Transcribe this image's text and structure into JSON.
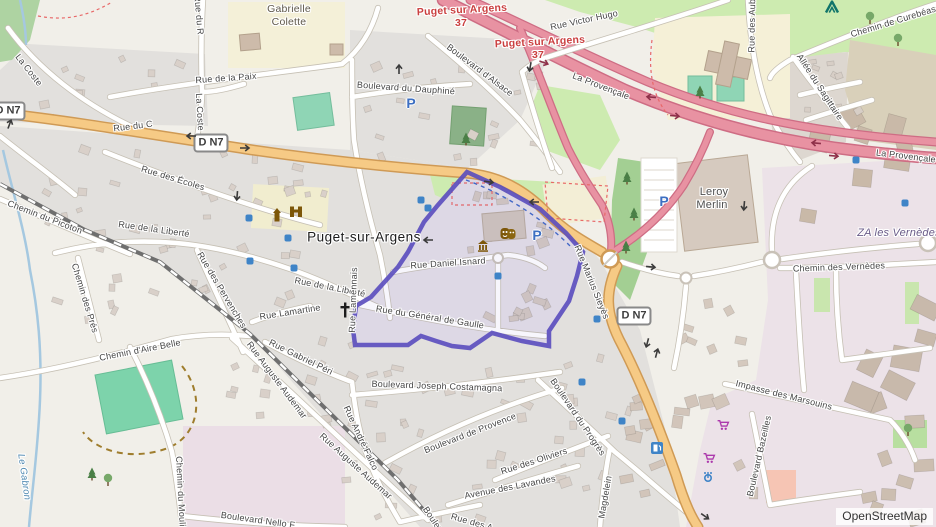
{
  "map": {
    "place": "Puget-sur-Argens",
    "attribution": "OpenStreetMap",
    "colors": {
      "motorway": "#e892a2",
      "primary": "#f6ca85",
      "highlight_boundary": "#5a4cbe",
      "water": "#a5c8e0",
      "grass": "#cdebb0",
      "pitch": "#8fd5b5",
      "residential": "#e2e0dd",
      "industrial": "#ece2e8",
      "school": "#f4efd6",
      "building": "#d9d0c9",
      "parking_blue": "#3d6fc2",
      "shop_purple": "#ac39ac",
      "historic_brown": "#7d5709",
      "junction_red": "#ca3f3f"
    },
    "badges": [
      {
        "t": "D N7",
        "x": 8,
        "y": 111
      },
      {
        "t": "D N7",
        "x": 211,
        "y": 143
      },
      {
        "t": "D N7",
        "x": 634,
        "y": 316
      }
    ],
    "labels": [
      {
        "t": "Gabrielle",
        "x": 289,
        "y": 9,
        "r": 0,
        "c": "area"
      },
      {
        "t": "Colette",
        "x": 289,
        "y": 22,
        "r": 0,
        "c": "area"
      },
      {
        "t": "La Coste",
        "x": 29,
        "y": 70,
        "r": 52
      },
      {
        "t": "Rue du R",
        "x": 199,
        "y": 15,
        "r": 85
      },
      {
        "t": "La Coste",
        "x": 200,
        "y": 112,
        "r": 87
      },
      {
        "t": "Rue de la Paix",
        "x": 226,
        "y": 78,
        "r": -4
      },
      {
        "t": "Rue du C",
        "x": 133,
        "y": 126,
        "r": -7
      },
      {
        "t": "Rue des Écoles",
        "x": 173,
        "y": 178,
        "r": 17
      },
      {
        "t": "Chemin du Picoton",
        "x": 45,
        "y": 217,
        "r": 21
      },
      {
        "t": "Rue de la Liberté",
        "x": 154,
        "y": 229,
        "r": 8
      },
      {
        "t": "Rue de la Liberté",
        "x": 330,
        "y": 287,
        "r": 11
      },
      {
        "t": "Chemin des Prés",
        "x": 85,
        "y": 298,
        "r": 73
      },
      {
        "t": "Rue des Pervenches",
        "x": 222,
        "y": 290,
        "r": 59
      },
      {
        "t": "Rue Lamartine",
        "x": 290,
        "y": 312,
        "r": -9
      },
      {
        "t": "Rue Lamennais",
        "x": 353,
        "y": 300,
        "r": -88
      },
      {
        "t": "Puget-sur-Argens",
        "x": 364,
        "y": 237,
        "r": 0,
        "c": "town"
      },
      {
        "t": "Rue Daniel Isnard",
        "x": 448,
        "y": 263,
        "r": -4
      },
      {
        "t": "Rue du Général de Gaulle",
        "x": 430,
        "y": 317,
        "r": 9
      },
      {
        "t": "Rue Marius Sieyès",
        "x": 592,
        "y": 282,
        "r": 68
      },
      {
        "t": "Boulevard du Dauphiné",
        "x": 406,
        "y": 88,
        "r": 4
      },
      {
        "t": "Boulevard d'Alsace",
        "x": 480,
        "y": 70,
        "r": 37
      },
      {
        "t": "Rue Victor Hugo",
        "x": 584,
        "y": 20,
        "r": -12
      },
      {
        "t": "La Provençale",
        "x": 601,
        "y": 86,
        "r": 21
      },
      {
        "t": "La Provençale",
        "x": 906,
        "y": 156,
        "r": 7
      },
      {
        "t": "Chemin de Curebéasse",
        "x": 898,
        "y": 20,
        "r": -17
      },
      {
        "t": "Rue des Aubrèdes",
        "x": 752,
        "y": 14,
        "r": -89
      },
      {
        "t": "Allée du Sagittaire",
        "x": 820,
        "y": 87,
        "r": 57
      },
      {
        "t": "Leroy",
        "x": 714,
        "y": 192,
        "r": 0,
        "c": "poiname"
      },
      {
        "t": "Merlin",
        "x": 712,
        "y": 205,
        "r": 0,
        "c": "poiname"
      },
      {
        "t": "ZA les Vernèdes",
        "x": 899,
        "y": 233,
        "r": 0,
        "c": "landuse"
      },
      {
        "t": "Chemin des Vernèdes",
        "x": 839,
        "y": 267,
        "r": -2
      },
      {
        "t": "Puget sur Argens",
        "x": 462,
        "y": 10,
        "r": -3,
        "c": "junction"
      },
      {
        "t": "37",
        "x": 461,
        "y": 23,
        "r": 0,
        "c": "junction"
      },
      {
        "t": "Puget sur Argens",
        "x": 540,
        "y": 42,
        "r": -3,
        "c": "junction"
      },
      {
        "t": "37",
        "x": 538,
        "y": 55,
        "r": 0,
        "c": "junction"
      },
      {
        "t": "Chemin d'Aire Belle",
        "x": 140,
        "y": 350,
        "r": -11
      },
      {
        "t": "Le Gabron",
        "x": 24,
        "y": 477,
        "r": 82,
        "c": "water"
      },
      {
        "t": "Rue Gabriel Péri",
        "x": 301,
        "y": 357,
        "r": 26
      },
      {
        "t": "Rue Auguste Audemar",
        "x": 277,
        "y": 380,
        "r": 53
      },
      {
        "t": "Rue Auguste Audemar",
        "x": 356,
        "y": 466,
        "r": 42
      },
      {
        "t": "Chemin du Moulin",
        "x": 181,
        "y": 494,
        "r": 87
      },
      {
        "t": "Boulevard Nello F",
        "x": 258,
        "y": 520,
        "r": 8
      },
      {
        "t": "Rue André Falco",
        "x": 361,
        "y": 438,
        "r": 65
      },
      {
        "t": "Boulevard Joseph Costamagna",
        "x": 437,
        "y": 386,
        "r": 2
      },
      {
        "t": "Boulevard de Provence",
        "x": 470,
        "y": 433,
        "r": -21
      },
      {
        "t": "Rue des Oliviers",
        "x": 534,
        "y": 461,
        "r": -18
      },
      {
        "t": "Avenue des Lavandes",
        "x": 510,
        "y": 487,
        "r": -11
      },
      {
        "t": "Boulevard du Progrès",
        "x": 578,
        "y": 417,
        "r": 56
      },
      {
        "t": "Magdelein",
        "x": 605,
        "y": 497,
        "r": -80
      },
      {
        "t": "Impasse des Marsouins",
        "x": 784,
        "y": 395,
        "r": 14
      },
      {
        "t": "Boulevard Bazeilles",
        "x": 759,
        "y": 456,
        "r": -77
      },
      {
        "t": "Rue des A",
        "x": 472,
        "y": 522,
        "r": 16
      },
      {
        "t": "Boulevard",
        "x": 437,
        "y": 525,
        "r": 56
      }
    ],
    "icons": [
      {
        "k": "parking",
        "x": 411,
        "y": 103
      },
      {
        "k": "parking",
        "x": 537,
        "y": 235
      },
      {
        "k": "parking",
        "x": 664,
        "y": 201
      },
      {
        "k": "poi-dot",
        "x": 249,
        "y": 218
      },
      {
        "k": "poi-dot",
        "x": 288,
        "y": 238
      },
      {
        "k": "poi-dot",
        "x": 250,
        "y": 261
      },
      {
        "k": "poi-dot",
        "x": 294,
        "y": 268
      },
      {
        "k": "poi-dot",
        "x": 421,
        "y": 200
      },
      {
        "k": "poi-dot",
        "x": 428,
        "y": 208
      },
      {
        "k": "poi-dot",
        "x": 498,
        "y": 276
      },
      {
        "k": "poi-dot",
        "x": 597,
        "y": 319
      },
      {
        "k": "poi-dot",
        "x": 582,
        "y": 382
      },
      {
        "k": "poi-dot",
        "x": 622,
        "y": 421
      },
      {
        "k": "poi-dot",
        "x": 856,
        "y": 160
      },
      {
        "k": "poi-dot",
        "x": 905,
        "y": 203
      },
      {
        "k": "supermarket-cart",
        "x": 723,
        "y": 425
      },
      {
        "k": "supermarket-cart",
        "x": 709,
        "y": 458
      },
      {
        "k": "fountain",
        "x": 708,
        "y": 476
      },
      {
        "k": "fuel",
        "x": 657,
        "y": 448
      },
      {
        "k": "campsite-tent",
        "x": 832,
        "y": 7
      },
      {
        "k": "historic-tower",
        "x": 277,
        "y": 215
      },
      {
        "k": "city-gate",
        "x": 296,
        "y": 211
      },
      {
        "k": "theatre-masks",
        "x": 508,
        "y": 234
      },
      {
        "k": "monument",
        "x": 483,
        "y": 246
      },
      {
        "k": "church-cross",
        "x": 345,
        "y": 310
      },
      {
        "k": "tree-conifer",
        "x": 466,
        "y": 139
      },
      {
        "k": "tree-conifer",
        "x": 627,
        "y": 178
      },
      {
        "k": "tree-conifer",
        "x": 634,
        "y": 214
      },
      {
        "k": "tree-conifer",
        "x": 626,
        "y": 247
      },
      {
        "k": "tree-conifer",
        "x": 700,
        "y": 92
      },
      {
        "k": "tree-conifer",
        "x": 92,
        "y": 474
      },
      {
        "k": "tree-round",
        "x": 870,
        "y": 18
      },
      {
        "k": "tree-round",
        "x": 898,
        "y": 40
      },
      {
        "k": "tree-round",
        "x": 108,
        "y": 480
      },
      {
        "k": "tree-round",
        "x": 908,
        "y": 430
      },
      {
        "k": "oneway-arrow",
        "x": 10,
        "y": 123,
        "r": -70
      },
      {
        "k": "oneway-arrow",
        "x": 190,
        "y": 136,
        "r": 180
      },
      {
        "k": "oneway-arrow",
        "x": 246,
        "y": 148,
        "r": 0
      },
      {
        "k": "oneway-arrow",
        "x": 399,
        "y": 68,
        "r": -90
      },
      {
        "k": "oneway-arrow",
        "x": 530,
        "y": 68,
        "r": 100
      },
      {
        "k": "oneway-arrow",
        "x": 237,
        "y": 197,
        "r": 95
      },
      {
        "k": "oneway-arrow",
        "x": 490,
        "y": 182,
        "r": 8
      },
      {
        "k": "oneway-arrow",
        "x": 427,
        "y": 240,
        "r": 180
      },
      {
        "k": "oneway-arrow",
        "x": 533,
        "y": 202,
        "r": 180
      },
      {
        "k": "oneway-arrow",
        "x": 744,
        "y": 207,
        "r": 95
      },
      {
        "k": "oneway-arrow",
        "x": 652,
        "y": 267,
        "r": 5
      },
      {
        "k": "oneway-arrow",
        "x": 647,
        "y": 344,
        "r": 105
      },
      {
        "k": "oneway-arrow",
        "x": 657,
        "y": 352,
        "r": -75
      },
      {
        "k": "oneway-arrow",
        "x": 706,
        "y": 517,
        "r": 35
      },
      {
        "k": "motorway-arrow",
        "x": 545,
        "y": 63,
        "r": 20
      },
      {
        "k": "motorway-arrow",
        "x": 650,
        "y": 97,
        "r": 185
      },
      {
        "k": "motorway-arrow",
        "x": 676,
        "y": 116,
        "r": 5
      },
      {
        "k": "motorway-arrow",
        "x": 815,
        "y": 143,
        "r": 185
      },
      {
        "k": "motorway-arrow",
        "x": 835,
        "y": 156,
        "r": 5
      }
    ]
  }
}
